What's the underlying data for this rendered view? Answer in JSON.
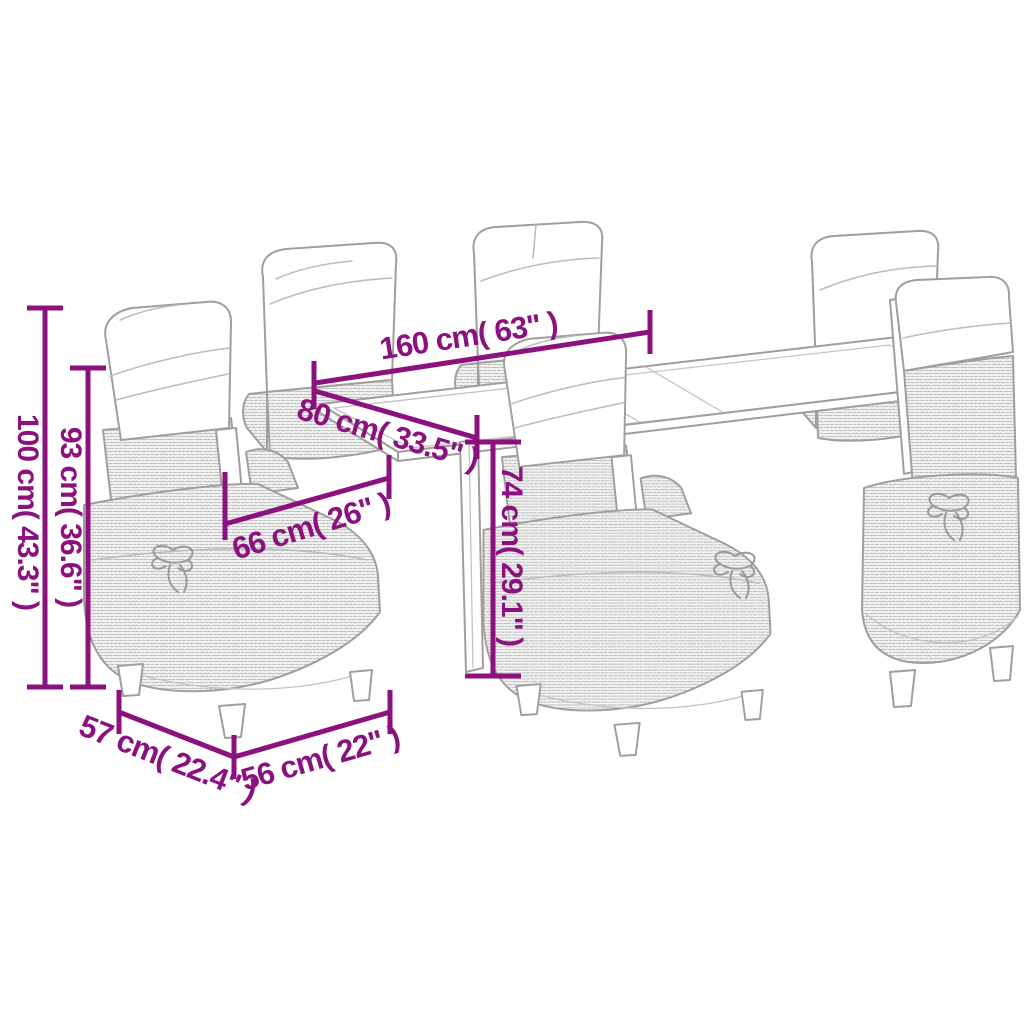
{
  "diagram": {
    "type": "product-dimension-line-art",
    "subject": "outdoor-dining-set-with-six-armchairs-and-table",
    "dimensions": {
      "table_length": "160 cm( 63\" )",
      "table_width": "80 cm( 33.5\" )",
      "chair_total_height": "100 cm( 43.3\" )",
      "chair_back_height": "93 cm( 36.6\" )",
      "chair_seat_width": "66 cm( 26\" )",
      "table_height": "74 cm( 29.1\" )",
      "chair_depth": "57 cm( 22.4\" )",
      "chair_width": "56 cm( 22\" )"
    },
    "colors": {
      "dimension_accent": "#8B127E",
      "line_art_outline": "#9f9f9f",
      "wicker_texture": "#c2c2c2",
      "cushion": "#ffffff",
      "background": "#ffffff"
    }
  }
}
